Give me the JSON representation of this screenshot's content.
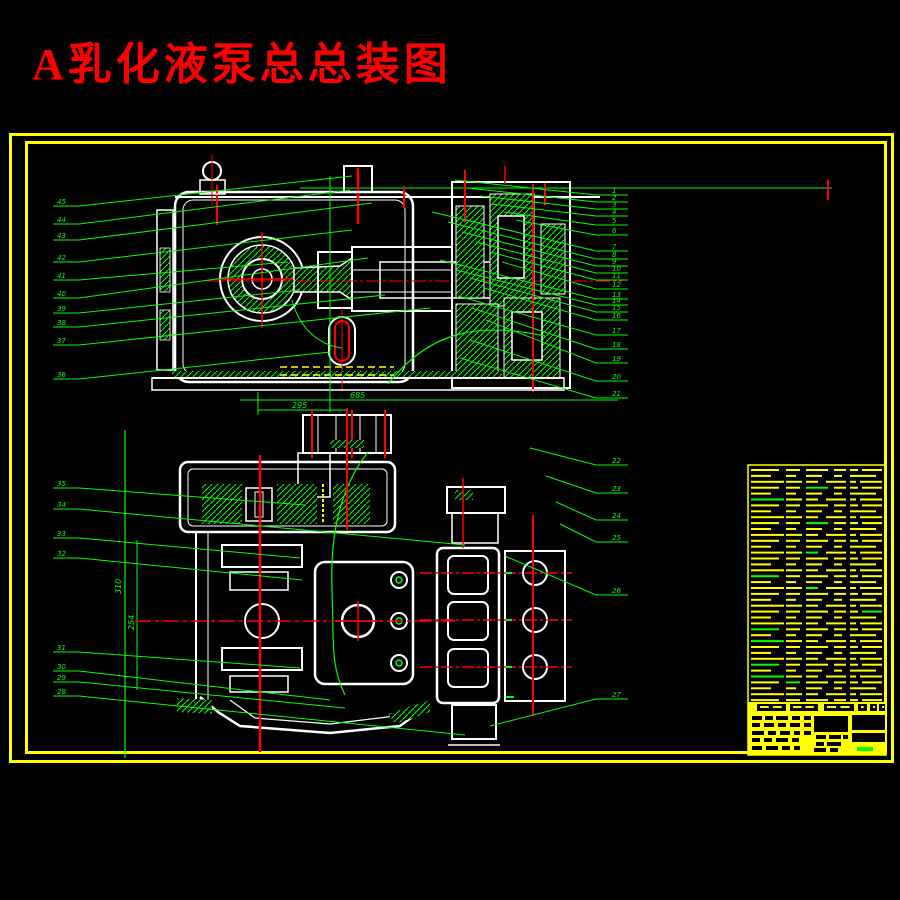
{
  "title": {
    "text": "A乳化液泵总总装图",
    "color": "#ff0000"
  },
  "colors": {
    "background": "#000000",
    "frame": "#ffff00",
    "outline": "#ffffff",
    "centerline": "#ff0000",
    "annotation": "#00ff00",
    "hidden_line": "#ffff00"
  },
  "dimensions": {
    "h1": {
      "label": "685"
    },
    "h2": {
      "label": "295"
    },
    "v1": {
      "label": "310"
    },
    "v2": {
      "label": "254"
    }
  },
  "callouts": {
    "top_left": {
      "lx": 57,
      "items": [
        {
          "n": "45",
          "ly": 203,
          "tx": 352,
          "ty": 176
        },
        {
          "n": "44",
          "ly": 221,
          "tx": 350,
          "ty": 190
        },
        {
          "n": "43",
          "ly": 237,
          "tx": 372,
          "ty": 203
        },
        {
          "n": "42",
          "ly": 259,
          "tx": 352,
          "ty": 230
        },
        {
          "n": "41",
          "ly": 277,
          "tx": 288,
          "ty": 262
        },
        {
          "n": "40",
          "ly": 295,
          "tx": 368,
          "ty": 258
        },
        {
          "n": "39",
          "ly": 310,
          "tx": 300,
          "ty": 290
        },
        {
          "n": "38",
          "ly": 324,
          "tx": 385,
          "ty": 295
        },
        {
          "n": "37",
          "ly": 342,
          "tx": 430,
          "ty": 308
        },
        {
          "n": "36",
          "ly": 376,
          "tx": 330,
          "ty": 352
        }
      ]
    },
    "top_right": {
      "lx": 612,
      "items": [
        {
          "n": "1",
          "ly": 192,
          "tx": 455,
          "ty": 180
        },
        {
          "n": "2",
          "ly": 199,
          "tx": 468,
          "ty": 188
        },
        {
          "n": "3",
          "ly": 206,
          "tx": 480,
          "ty": 196
        },
        {
          "n": "4",
          "ly": 213,
          "tx": 492,
          "ty": 204
        },
        {
          "n": "5",
          "ly": 222,
          "tx": 504,
          "ty": 212
        },
        {
          "n": "6",
          "ly": 232,
          "tx": 516,
          "ty": 220
        },
        {
          "n": "7",
          "ly": 248,
          "tx": 432,
          "ty": 212
        },
        {
          "n": "8",
          "ly": 256,
          "tx": 448,
          "ty": 222
        },
        {
          "n": "9",
          "ly": 263,
          "tx": 462,
          "ty": 232
        },
        {
          "n": "10",
          "ly": 270,
          "tx": 476,
          "ty": 242
        },
        {
          "n": "11",
          "ly": 277,
          "tx": 490,
          "ty": 252
        },
        {
          "n": "12",
          "ly": 286,
          "tx": 502,
          "ty": 262
        },
        {
          "n": "13",
          "ly": 296,
          "tx": 440,
          "ty": 260
        },
        {
          "n": "14",
          "ly": 302,
          "tx": 456,
          "ty": 270
        },
        {
          "n": "15",
          "ly": 309,
          "tx": 470,
          "ty": 278
        },
        {
          "n": "16",
          "ly": 317,
          "tx": 484,
          "ty": 288
        },
        {
          "n": "17",
          "ly": 332,
          "tx": 458,
          "ty": 296
        },
        {
          "n": "18",
          "ly": 346,
          "tx": 472,
          "ty": 308
        },
        {
          "n": "19",
          "ly": 360,
          "tx": 486,
          "ty": 320
        },
        {
          "n": "20",
          "ly": 378,
          "tx": 470,
          "ty": 340
        },
        {
          "n": "21",
          "ly": 395,
          "tx": 460,
          "ty": 358
        }
      ]
    },
    "bottom_right": {
      "lx": 612,
      "items": [
        {
          "n": "22",
          "ly": 462,
          "tx": 530,
          "ty": 448
        },
        {
          "n": "23",
          "ly": 490,
          "tx": 546,
          "ty": 476
        },
        {
          "n": "24",
          "ly": 517,
          "tx": 556,
          "ty": 502
        },
        {
          "n": "25",
          "ly": 539,
          "tx": 560,
          "ty": 524
        },
        {
          "n": "26",
          "ly": 592,
          "tx": 505,
          "ty": 556
        },
        {
          "n": "27",
          "ly": 696,
          "tx": 490,
          "ty": 726
        }
      ]
    },
    "bottom_left": {
      "lx": 57,
      "items": [
        {
          "n": "35",
          "ly": 485,
          "tx": 305,
          "ty": 505
        },
        {
          "n": "34",
          "ly": 506,
          "tx": 465,
          "ty": 545
        },
        {
          "n": "33",
          "ly": 535,
          "tx": 300,
          "ty": 558
        },
        {
          "n": "32",
          "ly": 555,
          "tx": 302,
          "ty": 580
        },
        {
          "n": "31",
          "ly": 649,
          "tx": 300,
          "ty": 668
        },
        {
          "n": "30",
          "ly": 668,
          "tx": 330,
          "ty": 700
        },
        {
          "n": "29",
          "ly": 679,
          "tx": 345,
          "ty": 708
        },
        {
          "n": "28",
          "ly": 693,
          "tx": 465,
          "ty": 735
        }
      ]
    }
  },
  "bom": {
    "x0": 748,
    "top": 465,
    "right": 886,
    "bottom": 755,
    "row_count": 40,
    "row_start_y": 469,
    "row_step": 5.9,
    "patterns": [
      [
        [
          3,
          28
        ],
        [
          38,
          14
        ],
        [
          58,
          22
        ],
        [
          86,
          12
        ],
        [
          102,
          8
        ],
        [
          114,
          20
        ]
      ],
      [
        [
          3,
          20
        ],
        [
          38,
          10
        ],
        [
          58,
          16
        ],
        [
          86,
          8
        ],
        [
          102,
          12
        ],
        [
          114,
          14
        ]
      ],
      [
        [
          3,
          33
        ],
        [
          38,
          16
        ],
        [
          58,
          12
        ],
        [
          78,
          20
        ],
        [
          102,
          6
        ],
        [
          112,
          22
        ]
      ]
    ],
    "green_rows": [
      [
        3,
        2
      ],
      [
        5,
        0
      ],
      [
        9,
        2
      ],
      [
        14,
        2
      ],
      [
        18,
        0
      ],
      [
        20,
        2
      ],
      [
        24,
        5
      ],
      [
        27,
        0
      ],
      [
        29,
        0
      ],
      [
        33,
        0
      ],
      [
        35,
        0
      ],
      [
        36,
        1
      ]
    ],
    "header_band": {
      "y": 702,
      "h": 11
    },
    "header_cells": [
      [
        757,
        29
      ],
      [
        790,
        28
      ],
      [
        824,
        30
      ],
      [
        858,
        9
      ],
      [
        870,
        7
      ],
      [
        879,
        6
      ]
    ],
    "block": {
      "y": 713,
      "h": 42
    },
    "block_cells": [
      [
        752,
        716,
        10,
        4
      ],
      [
        765,
        716,
        8,
        4
      ],
      [
        776,
        716,
        12,
        4
      ],
      [
        792,
        716,
        8,
        4
      ],
      [
        804,
        716,
        7,
        4
      ],
      [
        752,
        723,
        8,
        4
      ],
      [
        764,
        723,
        10,
        4
      ],
      [
        778,
        723,
        8,
        4
      ],
      [
        790,
        723,
        10,
        4
      ],
      [
        804,
        723,
        7,
        4
      ],
      [
        752,
        731,
        12,
        4
      ],
      [
        768,
        731,
        8,
        4
      ],
      [
        780,
        731,
        10,
        4
      ],
      [
        794,
        731,
        6,
        4
      ],
      [
        804,
        731,
        7,
        4
      ],
      [
        752,
        738,
        8,
        4
      ],
      [
        764,
        738,
        8,
        4
      ],
      [
        776,
        738,
        12,
        4
      ],
      [
        792,
        738,
        7,
        4
      ],
      [
        752,
        746,
        10,
        4
      ],
      [
        766,
        746,
        12,
        4
      ],
      [
        782,
        746,
        8,
        4
      ],
      [
        794,
        746,
        6,
        4
      ],
      [
        814,
        716,
        34,
        16
      ],
      [
        816,
        735,
        10,
        4
      ],
      [
        829,
        735,
        12,
        4
      ],
      [
        843,
        735,
        5,
        4
      ],
      [
        816,
        742,
        8,
        4
      ],
      [
        827,
        742,
        14,
        4
      ],
      [
        814,
        748,
        12,
        4
      ],
      [
        830,
        748,
        8,
        4
      ],
      [
        852,
        715,
        33,
        15
      ],
      [
        852,
        733,
        33,
        9
      ]
    ],
    "green_block": [
      857,
      747,
      16,
      4
    ]
  }
}
